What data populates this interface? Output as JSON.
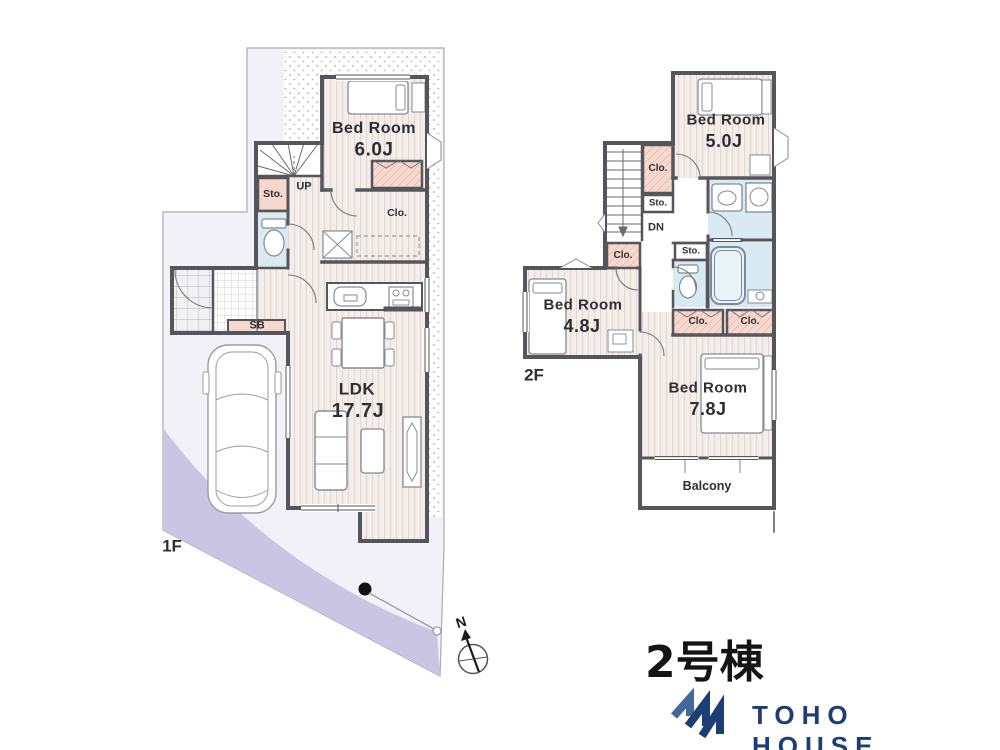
{
  "floor1": {
    "floor_label": "1F",
    "bedroom": {
      "label": "Bed Room",
      "size": "6.0J"
    },
    "ldk": {
      "label": "LDK",
      "size": "17.7J"
    },
    "storage": "Sto.",
    "stairs_up": "UP",
    "closet": "Clo.",
    "shoe_box": "SB"
  },
  "floor2": {
    "floor_label": "2F",
    "bedroom_5": {
      "label": "Bed Room",
      "size": "5.0J"
    },
    "bedroom_48": {
      "label": "Bed Room",
      "size": "4.8J"
    },
    "bedroom_78": {
      "label": "Bed Room",
      "size": "7.8J"
    },
    "balcony": "Balcony",
    "closet_stairs": "Clo.",
    "storage_stairs": "Sto.",
    "stairs_down": "DN",
    "closet_48": "Clo.",
    "storage_mid": "Sto.",
    "closet_left": "Clo.",
    "closet_right": "Clo."
  },
  "compass": {
    "north_label": "N"
  },
  "footer": {
    "unit_title": "2号棟",
    "brand_name": "TOHO HOUSE"
  },
  "colors": {
    "wall": "#55555b",
    "floor_stripe_bg": "#f3eee9",
    "closet_pink": "#f6d8cf",
    "wet_area_blue": "#d9eaf3",
    "site_accent_lavender": "#c9c5e2",
    "brand_navy": "#1c3e74"
  }
}
